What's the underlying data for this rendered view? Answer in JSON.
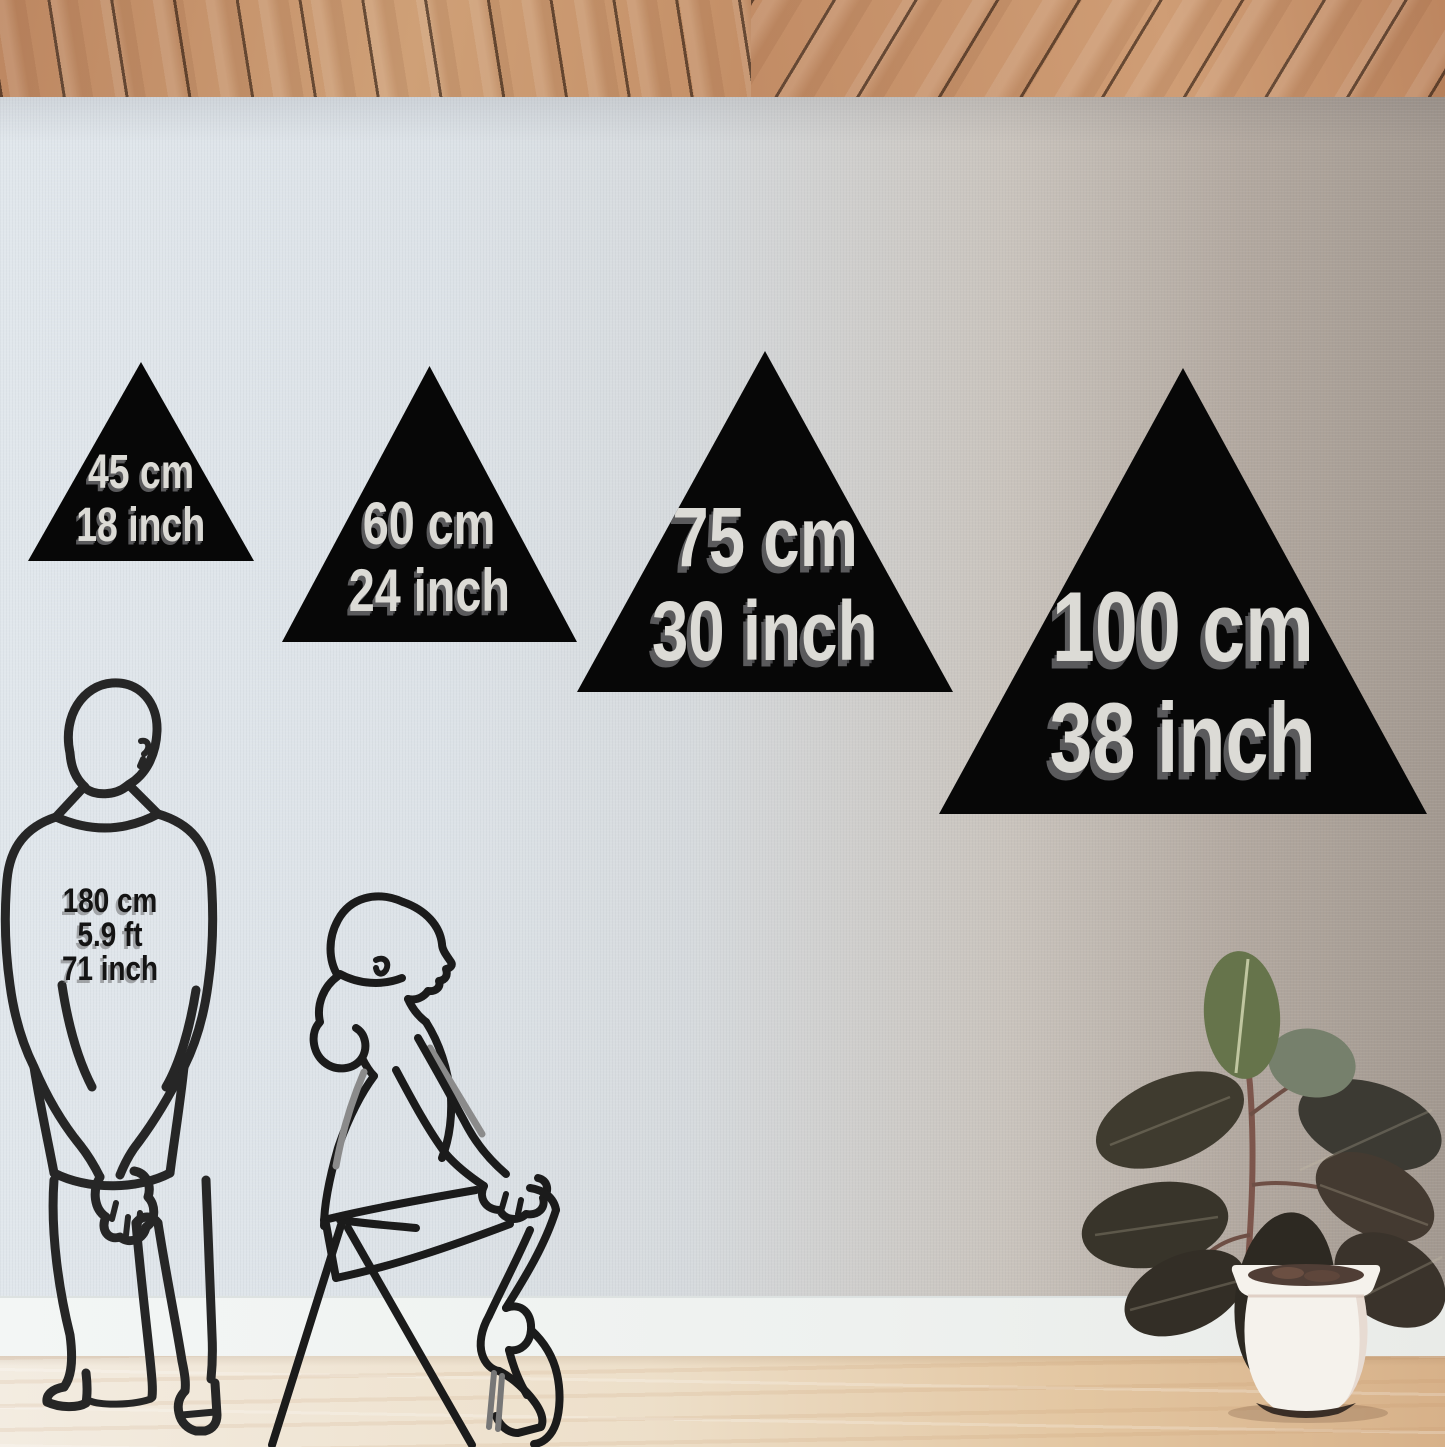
{
  "size_guide": {
    "triangles": [
      {
        "cm": "45 cm",
        "inch": "18 inch"
      },
      {
        "cm": "60 cm",
        "inch": "24 inch"
      },
      {
        "cm": "75 cm",
        "inch": "30 inch"
      },
      {
        "cm": "100 cm",
        "inch": "38 inch"
      }
    ],
    "person_height": {
      "cm": "180 cm",
      "ft": "5.9 ft",
      "inch": "71 inch"
    }
  },
  "colors": {
    "triangle_fill": "#070707",
    "triangle_label_text": "#dcdbd6",
    "triangle_label_shadow": "#5a5a5c",
    "person_label_text": "#141414",
    "figure_outline": "#262626",
    "ceiling_wood": "#c38e66",
    "wall_left": "#dde3e8",
    "wall_right": "#a2988f",
    "baseboard": "#f1f4f3",
    "floor_left": "#f3ece1",
    "floor_right": "#d7b189",
    "plant_top_leaf": "#66744b",
    "pot": "#f5f2ec"
  }
}
